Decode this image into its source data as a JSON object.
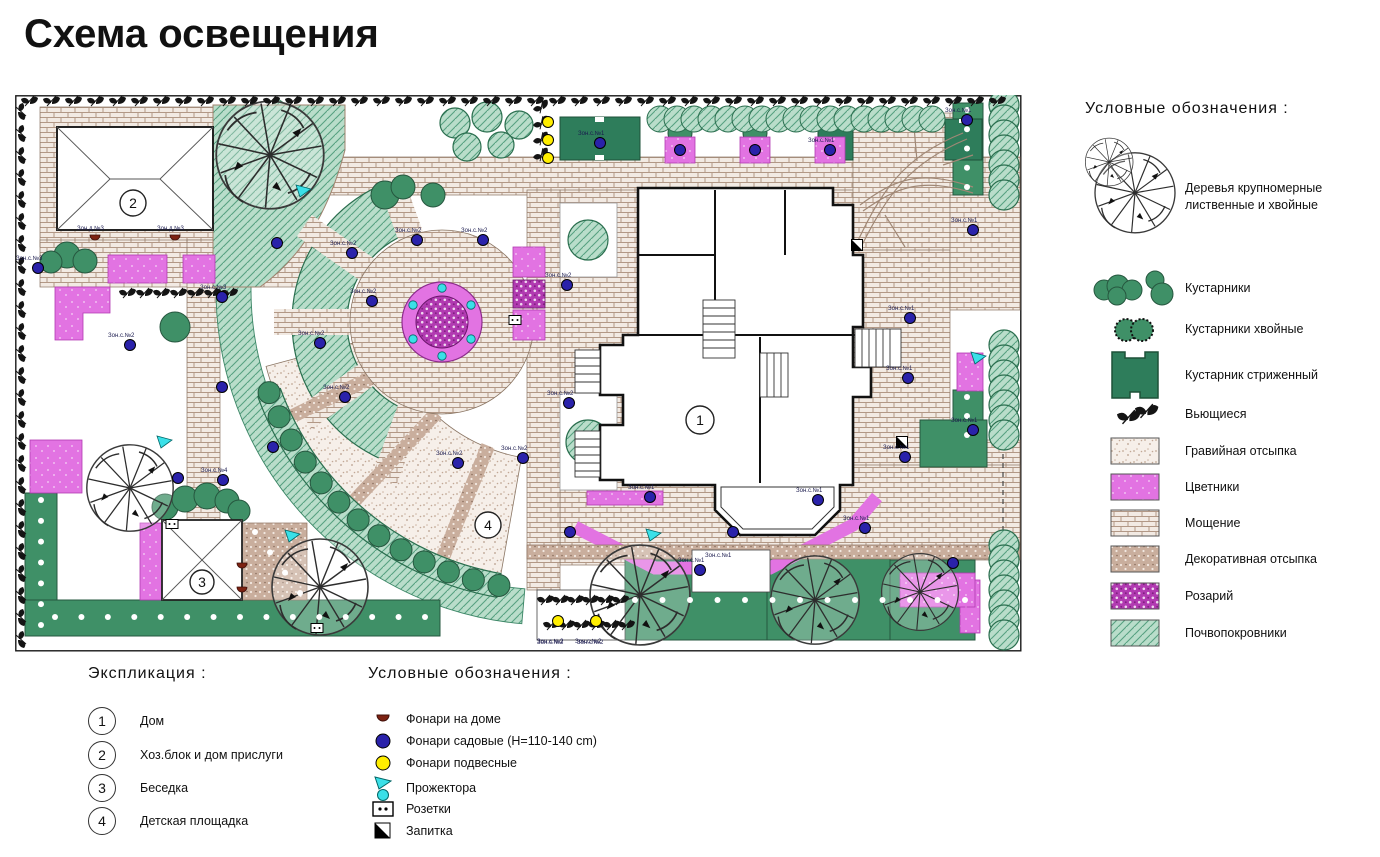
{
  "title": "Схема освещения",
  "colors": {
    "hedge_green": "#3f9067",
    "hedge_dark": "#26573f",
    "trimmed_green": "#2e7d5b",
    "groundcover_bg": "#b9ddca",
    "groundcover_line": "#57a181",
    "paving_bg": "#f2eae3",
    "paving_line": "#b29886",
    "gravel_bg": "#f6efe9",
    "decorative": "#c9ae9d",
    "flowerbed_magenta": "#e273e2",
    "rosary_purple": "#b13ab1",
    "lamp_garden_blue": "#2a22aa",
    "lamp_hanging_yellow": "#ffee00",
    "floodlight_cyan": "#3ae0e8",
    "lamp_house_red": "#7d2212"
  },
  "legend_right": {
    "heading": "Условные обозначения :",
    "items": [
      {
        "label": "Деревья крупномерные лиственные и хвойные",
        "symbol": "tree"
      },
      {
        "label": "Кустарники",
        "symbol": "shrubs"
      },
      {
        "label": "Кустарники хвойные",
        "symbol": "conifer-shrubs"
      },
      {
        "label": "Кустарник стриженный",
        "symbol": "trimmed-shrub"
      },
      {
        "label": "Вьющиеся",
        "symbol": "climbing"
      },
      {
        "label": "Гравийная отсыпка",
        "symbol": "gravel-swatch"
      },
      {
        "label": "Цветники",
        "symbol": "flowerbed-swatch"
      },
      {
        "label": "Мощение",
        "symbol": "paving-swatch"
      },
      {
        "label": "Декоративная отсыпка",
        "symbol": "decorative-swatch"
      },
      {
        "label": "Розарий",
        "symbol": "rosary-swatch"
      },
      {
        "label": "Почвопокровники",
        "symbol": "groundcover-swatch"
      }
    ]
  },
  "explication": {
    "heading": "Экспликация :",
    "items": [
      {
        "num": "1",
        "label": "Дом"
      },
      {
        "num": "2",
        "label": "Хоз.блок и дом прислуги"
      },
      {
        "num": "3",
        "label": "Беседка"
      },
      {
        "num": "4",
        "label": "Детская площадка"
      }
    ]
  },
  "legend_lights": {
    "heading": "Условные обозначения :",
    "items": [
      {
        "label": "Фонари на доме",
        "symbol": "house-lamp"
      },
      {
        "label": "Фонари садовые (H=110-140 cm)",
        "symbol": "garden-lamp"
      },
      {
        "label": "Фонари подвесные",
        "symbol": "hanging-lamp"
      },
      {
        "label": "Прожектора",
        "symbol": "floodlight"
      },
      {
        "label": "Розетки",
        "symbol": "socket"
      },
      {
        "label": "Запитка",
        "symbol": "power-feed"
      }
    ]
  },
  "plan": {
    "numbers": [
      {
        "n": "1",
        "x": 685,
        "y": 325,
        "r": 14
      },
      {
        "n": "2",
        "x": 118,
        "y": 108,
        "r": 13
      },
      {
        "n": "3",
        "x": 187,
        "y": 487,
        "r": 12
      },
      {
        "n": "4",
        "x": 473,
        "y": 430,
        "r": 13
      }
    ],
    "garden_lamps": [
      {
        "x": 23,
        "y": 173,
        "l": "Зон.с.№3"
      },
      {
        "x": 207,
        "y": 202,
        "l": "Зон.с.№3"
      },
      {
        "x": 207,
        "y": 292
      },
      {
        "x": 163,
        "y": 383
      },
      {
        "x": 208,
        "y": 385,
        "l": "Зон.с.№4"
      },
      {
        "x": 115,
        "y": 250,
        "l": "Зон.с.№2"
      },
      {
        "x": 262,
        "y": 148
      },
      {
        "x": 337,
        "y": 158,
        "l": "Зон.с.№2"
      },
      {
        "x": 402,
        "y": 145,
        "l": "Зон.с.№2"
      },
      {
        "x": 468,
        "y": 145,
        "l": "Зон.с.№2"
      },
      {
        "x": 357,
        "y": 206,
        "l": "Зон.с.№2"
      },
      {
        "x": 305,
        "y": 248,
        "l": "Зон.с.№2"
      },
      {
        "x": 330,
        "y": 302,
        "l": "Зон.с.№2"
      },
      {
        "x": 258,
        "y": 352
      },
      {
        "x": 443,
        "y": 368,
        "l": "Зон.с.№2"
      },
      {
        "x": 508,
        "y": 363,
        "l": "Зон.с.№2"
      },
      {
        "x": 555,
        "y": 437
      },
      {
        "x": 635,
        "y": 402,
        "l": "Зон.с.№1"
      },
      {
        "x": 585,
        "y": 48,
        "l": "Зон.с.№1"
      },
      {
        "x": 665,
        "y": 55
      },
      {
        "x": 740,
        "y": 55
      },
      {
        "x": 815,
        "y": 55,
        "l": "Зон.с.№1"
      },
      {
        "x": 952,
        "y": 25,
        "l": "Зон.с.№1"
      },
      {
        "x": 958,
        "y": 135,
        "l": "Зон.с.№1"
      },
      {
        "x": 552,
        "y": 190,
        "l": "Зон.с.№2"
      },
      {
        "x": 554,
        "y": 308,
        "l": "Зон.с.№2"
      },
      {
        "x": 895,
        "y": 223,
        "l": "Зон.с.№1"
      },
      {
        "x": 893,
        "y": 283,
        "l": "Зон.с.№1"
      },
      {
        "x": 890,
        "y": 362,
        "l": "Зон.с.№1"
      },
      {
        "x": 958,
        "y": 335,
        "l": "Зон.с.№1"
      },
      {
        "x": 803,
        "y": 405,
        "l": "Зон.с.№1"
      },
      {
        "x": 718,
        "y": 437
      },
      {
        "x": 850,
        "y": 433,
        "l": "Зон.с.№1"
      },
      {
        "x": 938,
        "y": 468
      },
      {
        "x": 685,
        "y": 475,
        "l": "Зон.с.№1"
      }
    ],
    "hanging_lamps": [
      {
        "x": 533,
        "y": 27
      },
      {
        "x": 533,
        "y": 45
      },
      {
        "x": 533,
        "y": 63
      },
      {
        "x": 543,
        "y": 526,
        "l": "Зон.с.№2"
      },
      {
        "x": 581,
        "y": 526,
        "l": "Зон.с.№2"
      }
    ],
    "floodlights": [
      {
        "x": 288,
        "y": 96,
        "t": "tri"
      },
      {
        "x": 149,
        "y": 347,
        "t": "tri"
      },
      {
        "x": 277,
        "y": 441,
        "t": "tri"
      },
      {
        "x": 638,
        "y": 440,
        "t": "tri"
      },
      {
        "x": 963,
        "y": 263,
        "t": "tri"
      },
      {
        "x": 456,
        "y": 210,
        "t": "dot"
      },
      {
        "x": 456,
        "y": 244,
        "t": "dot"
      },
      {
        "x": 427,
        "y": 261,
        "t": "dot"
      },
      {
        "x": 398,
        "y": 244,
        "t": "dot"
      },
      {
        "x": 398,
        "y": 210,
        "t": "dot"
      },
      {
        "x": 427,
        "y": 193,
        "t": "dot"
      }
    ],
    "house_lamps": [
      {
        "x": 80,
        "y": 140,
        "l": "Зон.д.№3"
      },
      {
        "x": 160,
        "y": 140,
        "l": "Зон.д.№3"
      },
      {
        "x": 227,
        "y": 468
      },
      {
        "x": 227,
        "y": 492
      }
    ],
    "sockets": [
      {
        "x": 157,
        "y": 429
      },
      {
        "x": 500,
        "y": 225
      },
      {
        "x": 302,
        "y": 533
      }
    ],
    "power_feeds": [
      {
        "x": 842,
        "y": 150
      },
      {
        "x": 887,
        "y": 347
      }
    ],
    "trees": [
      {
        "x": 255,
        "y": 60,
        "r": 56
      },
      {
        "x": 115,
        "y": 393,
        "r": 45
      },
      {
        "x": 305,
        "y": 492,
        "r": 50
      },
      {
        "x": 625,
        "y": 500,
        "r": 52
      },
      {
        "x": 800,
        "y": 505,
        "r": 46
      },
      {
        "x": 905,
        "y": 497,
        "r": 40
      }
    ],
    "labels": [
      {
        "x": 522,
        "y": 549,
        "t": "Зон.с.№2"
      },
      {
        "x": 562,
        "y": 549,
        "t": "Зон.с.№2"
      },
      {
        "x": 690,
        "y": 462,
        "t": "Зон.с.№1"
      }
    ]
  }
}
